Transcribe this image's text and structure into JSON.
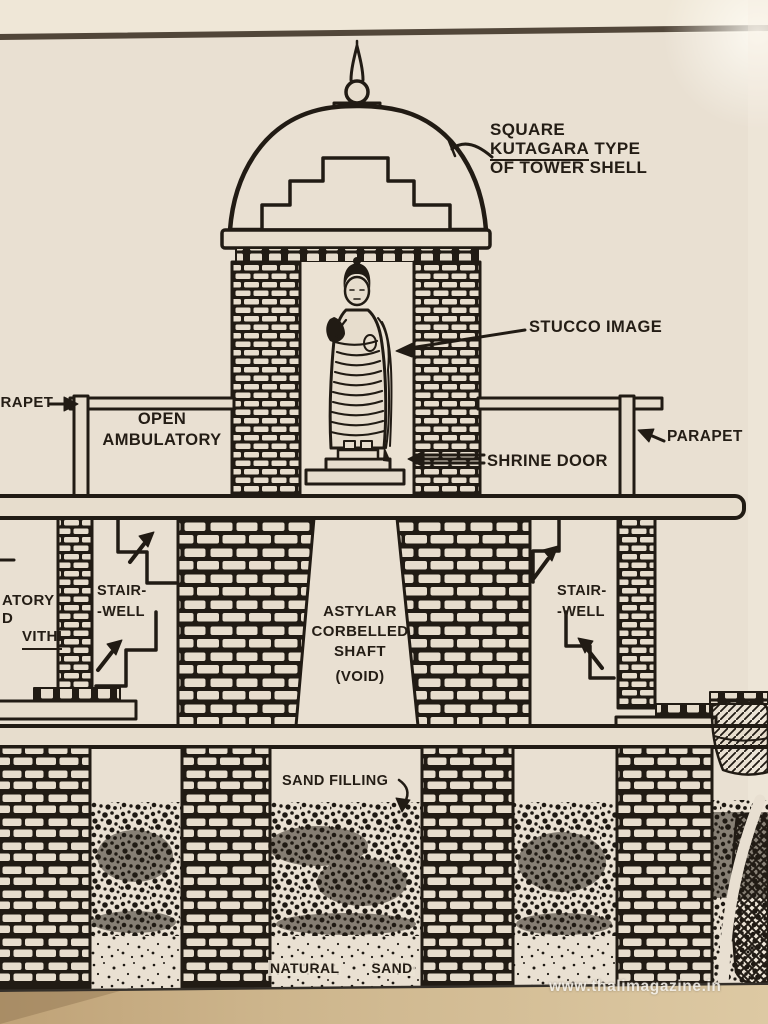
{
  "labels": {
    "tower": {
      "l1": "SQUARE",
      "kutagara": "KUTAGARA",
      "l2rest": "TYPE",
      "l3": "OF TOWER SHELL"
    },
    "stucco": "STUCCO IMAGE",
    "parapet_left": "PARAPET",
    "parapet_right": "PARAPET",
    "ambulatory": {
      "l1": "OPEN",
      "l2": "AMBULATORY"
    },
    "shrine_door": "SHRINE DOOR",
    "edge_fragments": {
      "f1": "ATORY",
      "f2": "D",
      "f3": "VITHI"
    },
    "stair_left": {
      "l1": "STAIR-",
      "l2": "-WELL"
    },
    "stair_right": {
      "l1": "STAIR-",
      "l2": "-WELL"
    },
    "shaft": {
      "l1": "ASTYLAR",
      "l2": "CORBELLED",
      "l3": "SHAFT",
      "l4": "(VOID)"
    },
    "sand_filling": "SAND FILLING",
    "natural_sand": {
      "w1": "NATURAL",
      "w2": "SAND"
    },
    "watermark": "www.thalimagazine.in"
  },
  "colors": {
    "paper": "#e9e0d2",
    "ink": "#211b14",
    "bottom_band": "#d4bf9d",
    "watermark_text": "#f8f5ee"
  }
}
